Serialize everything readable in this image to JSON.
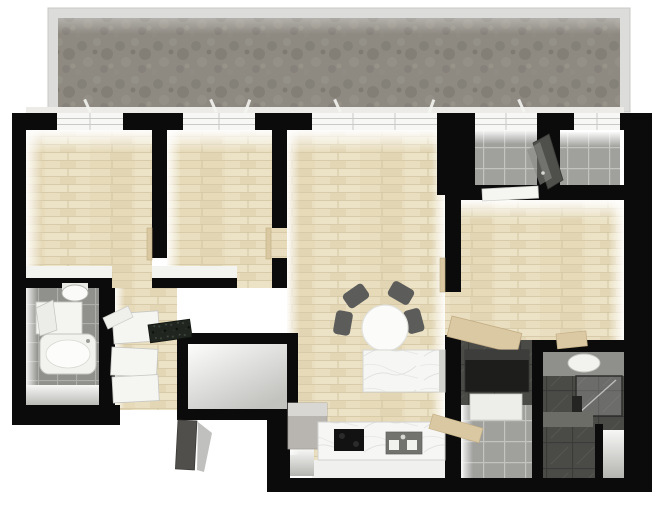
{
  "title": "3D apartment floor plan, top-down view",
  "image_type": "architectural-floor-plan-3d-render",
  "visible_text": [],
  "palette": {
    "wall": "#0b0b0b",
    "wood_floor": "#e9debf",
    "balcony_floor": "#8e8a82",
    "balcony_railing": "#dcdcda",
    "tile_light": "#a0a09d",
    "tile_bath": "#90908c",
    "tile_dark": "#4a4a47",
    "marble": "#f6f6f4",
    "door_wood": "#d9c8a2",
    "chair_gray": "#5c5c5a",
    "background": "#ffffff"
  },
  "balcony": {
    "position": "top",
    "railing": true,
    "floor": "gray mottled stone"
  },
  "windows": {
    "count": 5,
    "location": "top exterior wall between black piers"
  },
  "rooms": [
    {
      "name": "bedroom-1",
      "position": "top-left",
      "floor": "wood"
    },
    {
      "name": "bedroom-2",
      "position": "top-center-left",
      "floor": "wood"
    },
    {
      "name": "living-room",
      "position": "center",
      "floor": "wood"
    },
    {
      "name": "kitchen",
      "position": "bottom-center",
      "floor": "white tile",
      "features": [
        "counter",
        "cooktop",
        "sink",
        "island",
        "tall cabinet"
      ]
    },
    {
      "name": "hallway",
      "position": "center-left",
      "floor": "wood",
      "features": [
        "wardrobes",
        "dark stone slab"
      ]
    },
    {
      "name": "bathroom-1",
      "position": "left",
      "floor": "gray tile",
      "features": [
        "toilet",
        "vanity",
        "bathtub"
      ]
    },
    {
      "name": "storage-room",
      "position": "bottom-center-left",
      "floor": "shaded white"
    },
    {
      "name": "entry-room-a",
      "position": "top-right",
      "floor": "light gray tile",
      "features": [
        "open dark door",
        "white door leaf"
      ]
    },
    {
      "name": "entry-room-b",
      "position": "top-right-corner",
      "floor": "light gray tile"
    },
    {
      "name": "bedroom-3",
      "position": "right",
      "floor": "wood",
      "features": [
        "angled desk"
      ]
    },
    {
      "name": "utility-room",
      "position": "bottom-right-center",
      "floor": "gray tile",
      "features": [
        "dark appliance",
        "open wood door"
      ]
    },
    {
      "name": "bathroom-2",
      "position": "bottom-right",
      "floor": "dark tile",
      "features": [
        "vanity basin",
        "glass shower",
        "bench"
      ]
    }
  ],
  "furniture": [
    {
      "name": "dining-table",
      "shape": "round",
      "color": "white",
      "chairs": 4
    },
    {
      "name": "kitchen-island",
      "material": "white marble"
    },
    {
      "name": "kitchen-counter",
      "material": "white marble"
    },
    {
      "name": "cooktop",
      "color": "black"
    },
    {
      "name": "kitchen-sink",
      "basins": 2
    },
    {
      "name": "tall-cabinet",
      "color": "gray"
    },
    {
      "name": "bathtub",
      "room": "bathroom-1"
    },
    {
      "name": "toilet",
      "room": "bathroom-1"
    },
    {
      "name": "vanity",
      "room": "bathroom-1"
    },
    {
      "name": "wardrobes",
      "room": "hallway",
      "count": 3
    },
    {
      "name": "stone-slab",
      "room": "hallway"
    },
    {
      "name": "desk",
      "room": "bedroom-3",
      "material": "light wood"
    },
    {
      "name": "dark-appliance",
      "room": "utility-room"
    },
    {
      "name": "basin",
      "room": "bathroom-2"
    },
    {
      "name": "glass-shower",
      "room": "bathroom-2"
    },
    {
      "name": "entrance-door",
      "state": "open",
      "color": "dark gray"
    },
    {
      "name": "interior-doors",
      "state": "open",
      "color": "light wood",
      "count": 5
    }
  ]
}
